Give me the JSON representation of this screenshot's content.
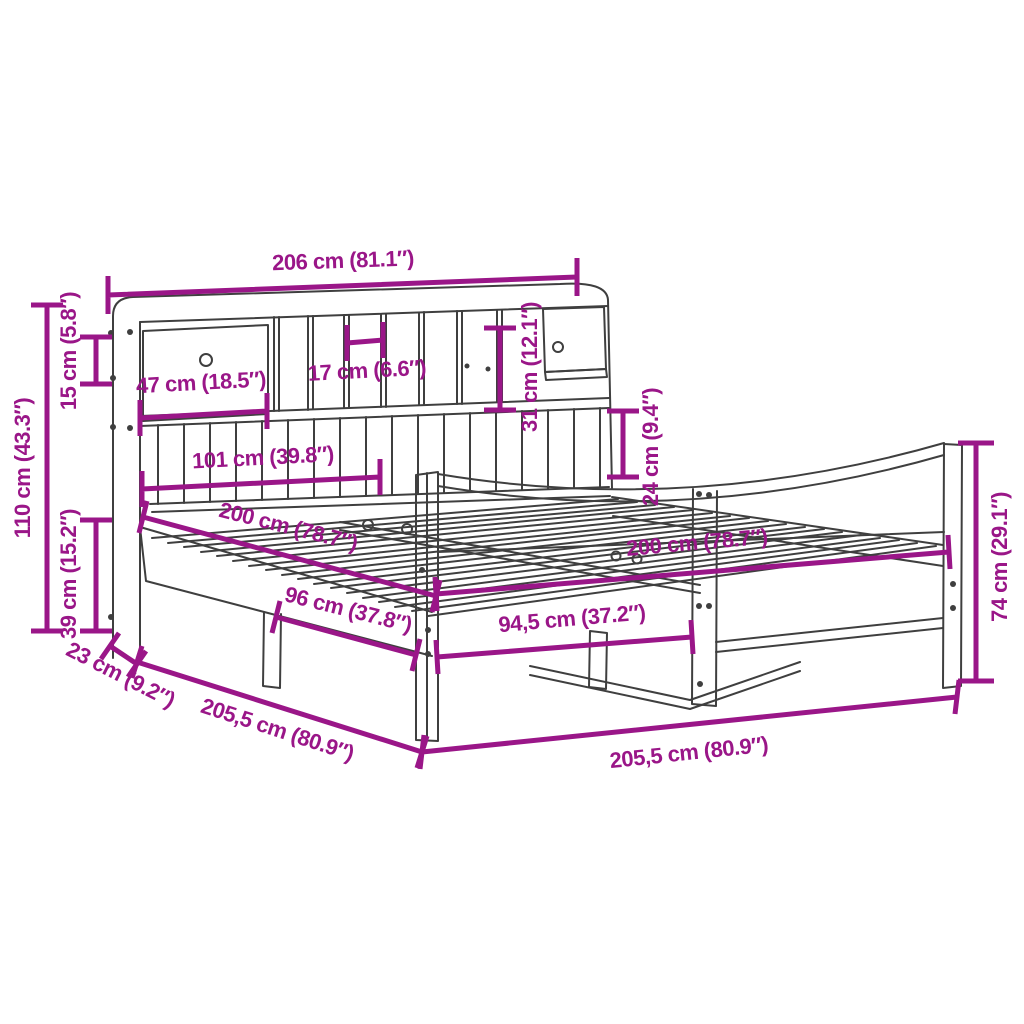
{
  "diagram": {
    "title": "bed-frame-with-bookshelf-headboard-dimension-diagram",
    "background_color": "#ffffff",
    "dimension_color": "#9A1688",
    "outline_color": "#3f3f3f",
    "units": [
      "cm",
      "in"
    ],
    "measurements": [
      {
        "name": "overall-width-top",
        "cm": "206",
        "in": "81.1",
        "label": "206 cm (81.1″)"
      },
      {
        "name": "overall-height",
        "cm": "110",
        "in": "43.3",
        "label": "110 cm (43.3″)"
      },
      {
        "name": "top-shelf-height",
        "cm": "15",
        "in": "5.8",
        "label": "15 cm (5.8″)"
      },
      {
        "name": "under-bed-height",
        "cm": "39",
        "in": "15.2",
        "label": "39 cm (15.2″)"
      },
      {
        "name": "headboard-depth",
        "cm": "23",
        "in": "9.2",
        "label": "23 cm (9.2″)"
      },
      {
        "name": "overall-length-left",
        "cm": "205,5",
        "in": "80.9",
        "label": "205,5 cm (80.9″)"
      },
      {
        "name": "overall-length-right",
        "cm": "205,5",
        "in": "80.9",
        "label": "205,5 cm (80.9″)"
      },
      {
        "name": "drawer-compartment-width",
        "cm": "47",
        "in": "18.5",
        "label": "47 cm (18.5″)"
      },
      {
        "name": "cubby-width",
        "cm": "17",
        "in": "6.6",
        "label": "17 cm (6.6″)"
      },
      {
        "name": "side-compartment-height",
        "cm": "31",
        "in": "12.1",
        "label": "31 cm (12.1″)"
      },
      {
        "name": "shelf-to-footboard-gap",
        "cm": "24",
        "in": "9.4",
        "label": "24 cm (9.4″)"
      },
      {
        "name": "slat-panel-width",
        "cm": "101",
        "in": "39.8",
        "label": "101 cm (39.8″)"
      },
      {
        "name": "mattress-length-headboard",
        "cm": "200",
        "in": "78.7",
        "label": "200 cm (78.7″)"
      },
      {
        "name": "mattress-length-footboard",
        "cm": "200",
        "in": "78.7",
        "label": "200 cm (78.7″)"
      },
      {
        "name": "inner-width-headboard",
        "cm": "96",
        "in": "37.8",
        "label": "96 cm (37.8″)"
      },
      {
        "name": "inner-width-footboard",
        "cm": "94,5",
        "in": "37.2",
        "label": "94,5 cm (37.2″)"
      },
      {
        "name": "footboard-height",
        "cm": "74",
        "in": "29.1",
        "label": "74 cm (29.1″)"
      }
    ]
  }
}
